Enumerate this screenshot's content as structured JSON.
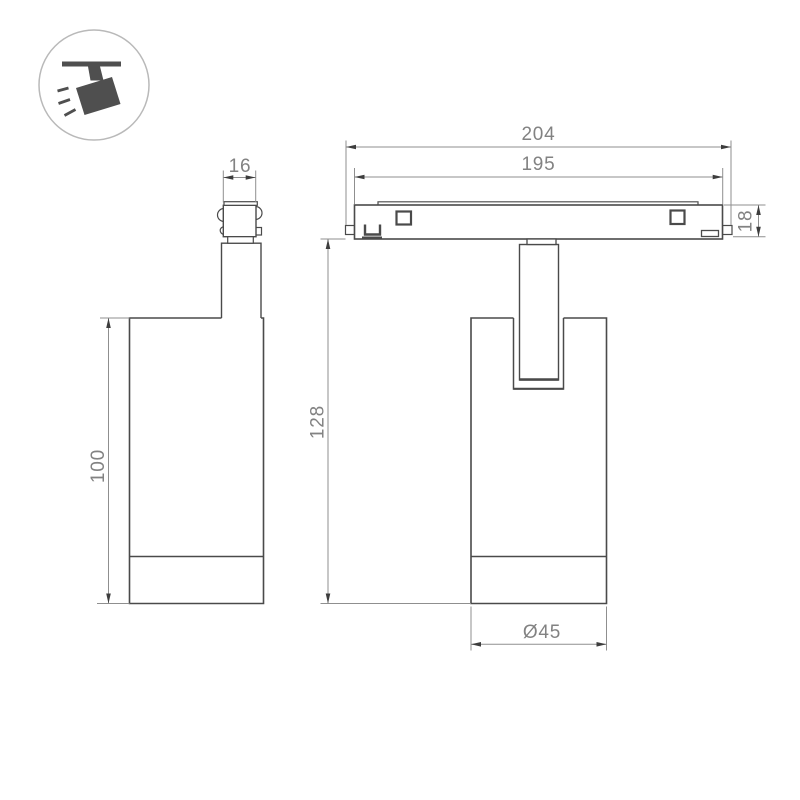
{
  "drawing": {
    "type": "technical-dimension-drawing",
    "views": [
      "side-view",
      "front-view"
    ],
    "dimensions": {
      "adapter_width": "16",
      "track_length": "204",
      "track_inner_length": "195",
      "track_height": "18",
      "body_height": "100",
      "total_height": "128",
      "body_diameter": "Ø45"
    }
  },
  "icons": {
    "badge": "track-spotlight-icon"
  },
  "colors": {
    "outline": "#4a4a4a",
    "dimension_line": "#8f8f8f",
    "dimension_text": "#828282",
    "arrowhead": "#3d3d3d",
    "icon_fill": "#4f4f4f",
    "icon_ring": "#b9b9b9",
    "background": "#ffffff"
  }
}
